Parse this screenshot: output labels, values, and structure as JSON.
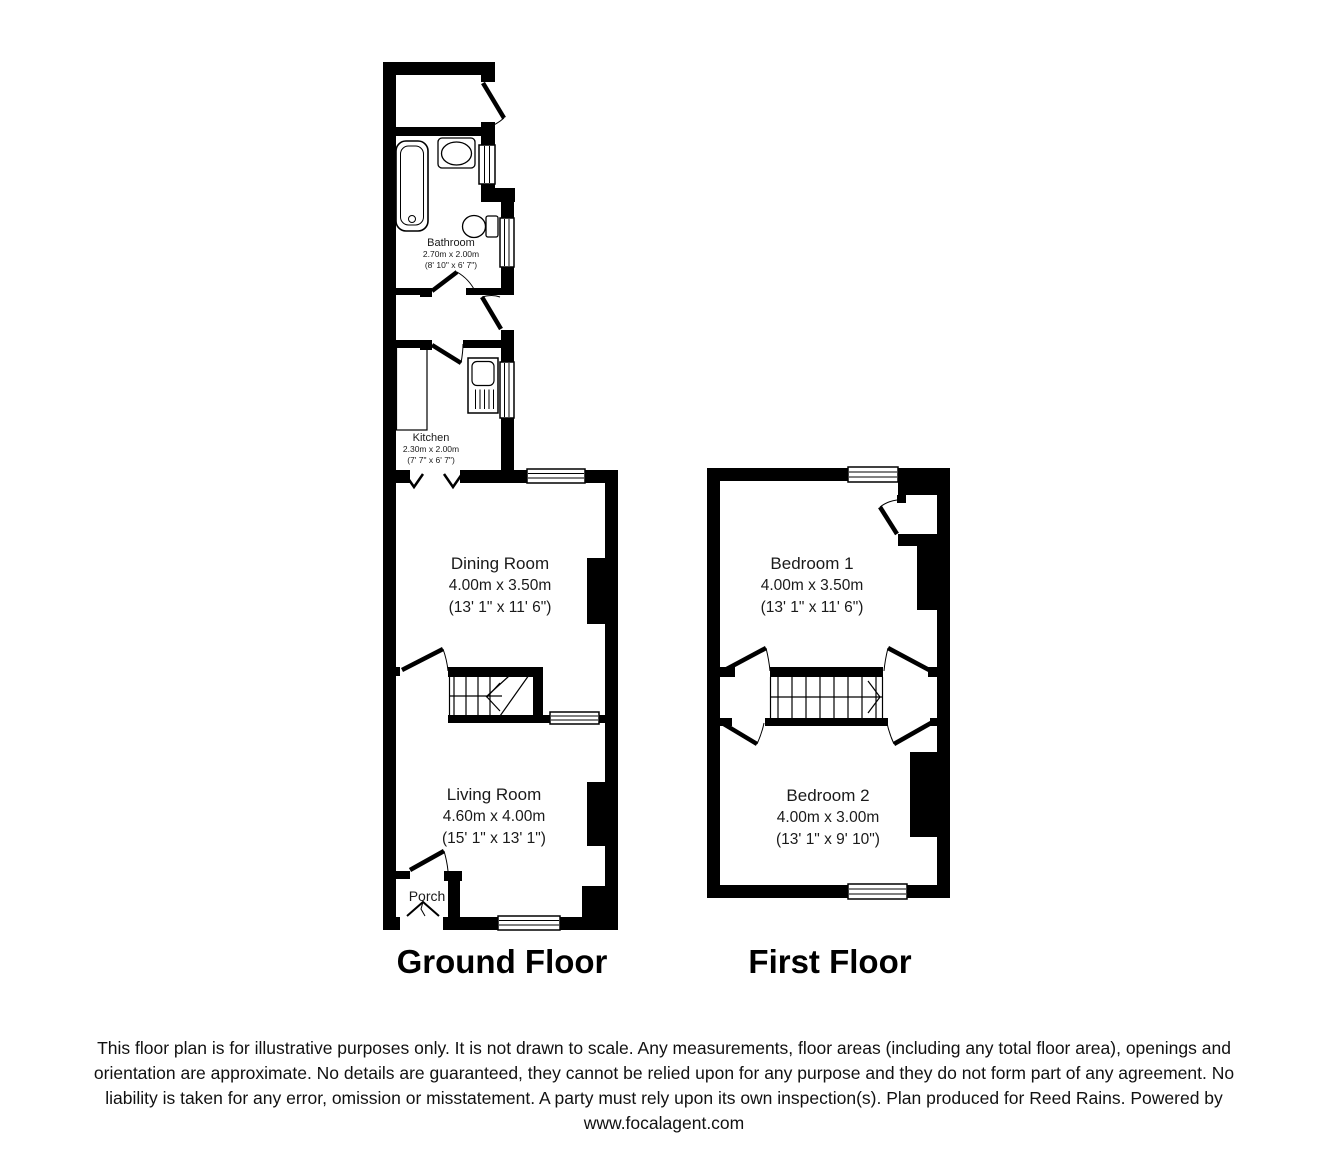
{
  "colors": {
    "walls": "#000000",
    "background": "#ffffff",
    "text": "#000000"
  },
  "ground_floor": {
    "label": "Ground Floor",
    "rooms": {
      "bathroom": {
        "name": "Bathroom",
        "metric": "2.70m x 2.00m",
        "imperial": "(8' 10\" x 6' 7\")"
      },
      "kitchen": {
        "name": "Kitchen",
        "metric": "2.30m x 2.00m",
        "imperial": "(7' 7\" x 6' 7\")"
      },
      "dining_room": {
        "name": "Dining Room",
        "metric": "4.00m x 3.50m",
        "imperial": "(13' 1\" x 11' 6\")"
      },
      "living_room": {
        "name": "Living Room",
        "metric": "4.60m x 4.00m",
        "imperial": "(15' 1\" x 13' 1\")"
      },
      "porch": {
        "name": "Porch"
      }
    }
  },
  "first_floor": {
    "label": "First Floor",
    "rooms": {
      "bedroom_1": {
        "name": "Bedroom 1",
        "metric": "4.00m x 3.50m",
        "imperial": "(13' 1\" x 11' 6\")"
      },
      "bedroom_2": {
        "name": "Bedroom 2",
        "metric": "4.00m x 3.00m",
        "imperial": "(13' 1\" x 9' 10\")"
      }
    }
  },
  "footer": {
    "lines": [
      "This floor plan is for illustrative purposes only. It is not drawn to scale. Any measurements, floor areas (including any total floor area), openings and",
      "orientation are approximate. No details are guaranteed, they cannot be relied upon for any purpose and they do not form part of any agreement. No",
      "liability is taken for any error, omission or misstatement. A party must rely upon its own inspection(s). Plan produced for Reed Rains. Powered by",
      "www.focalagent.com"
    ]
  }
}
